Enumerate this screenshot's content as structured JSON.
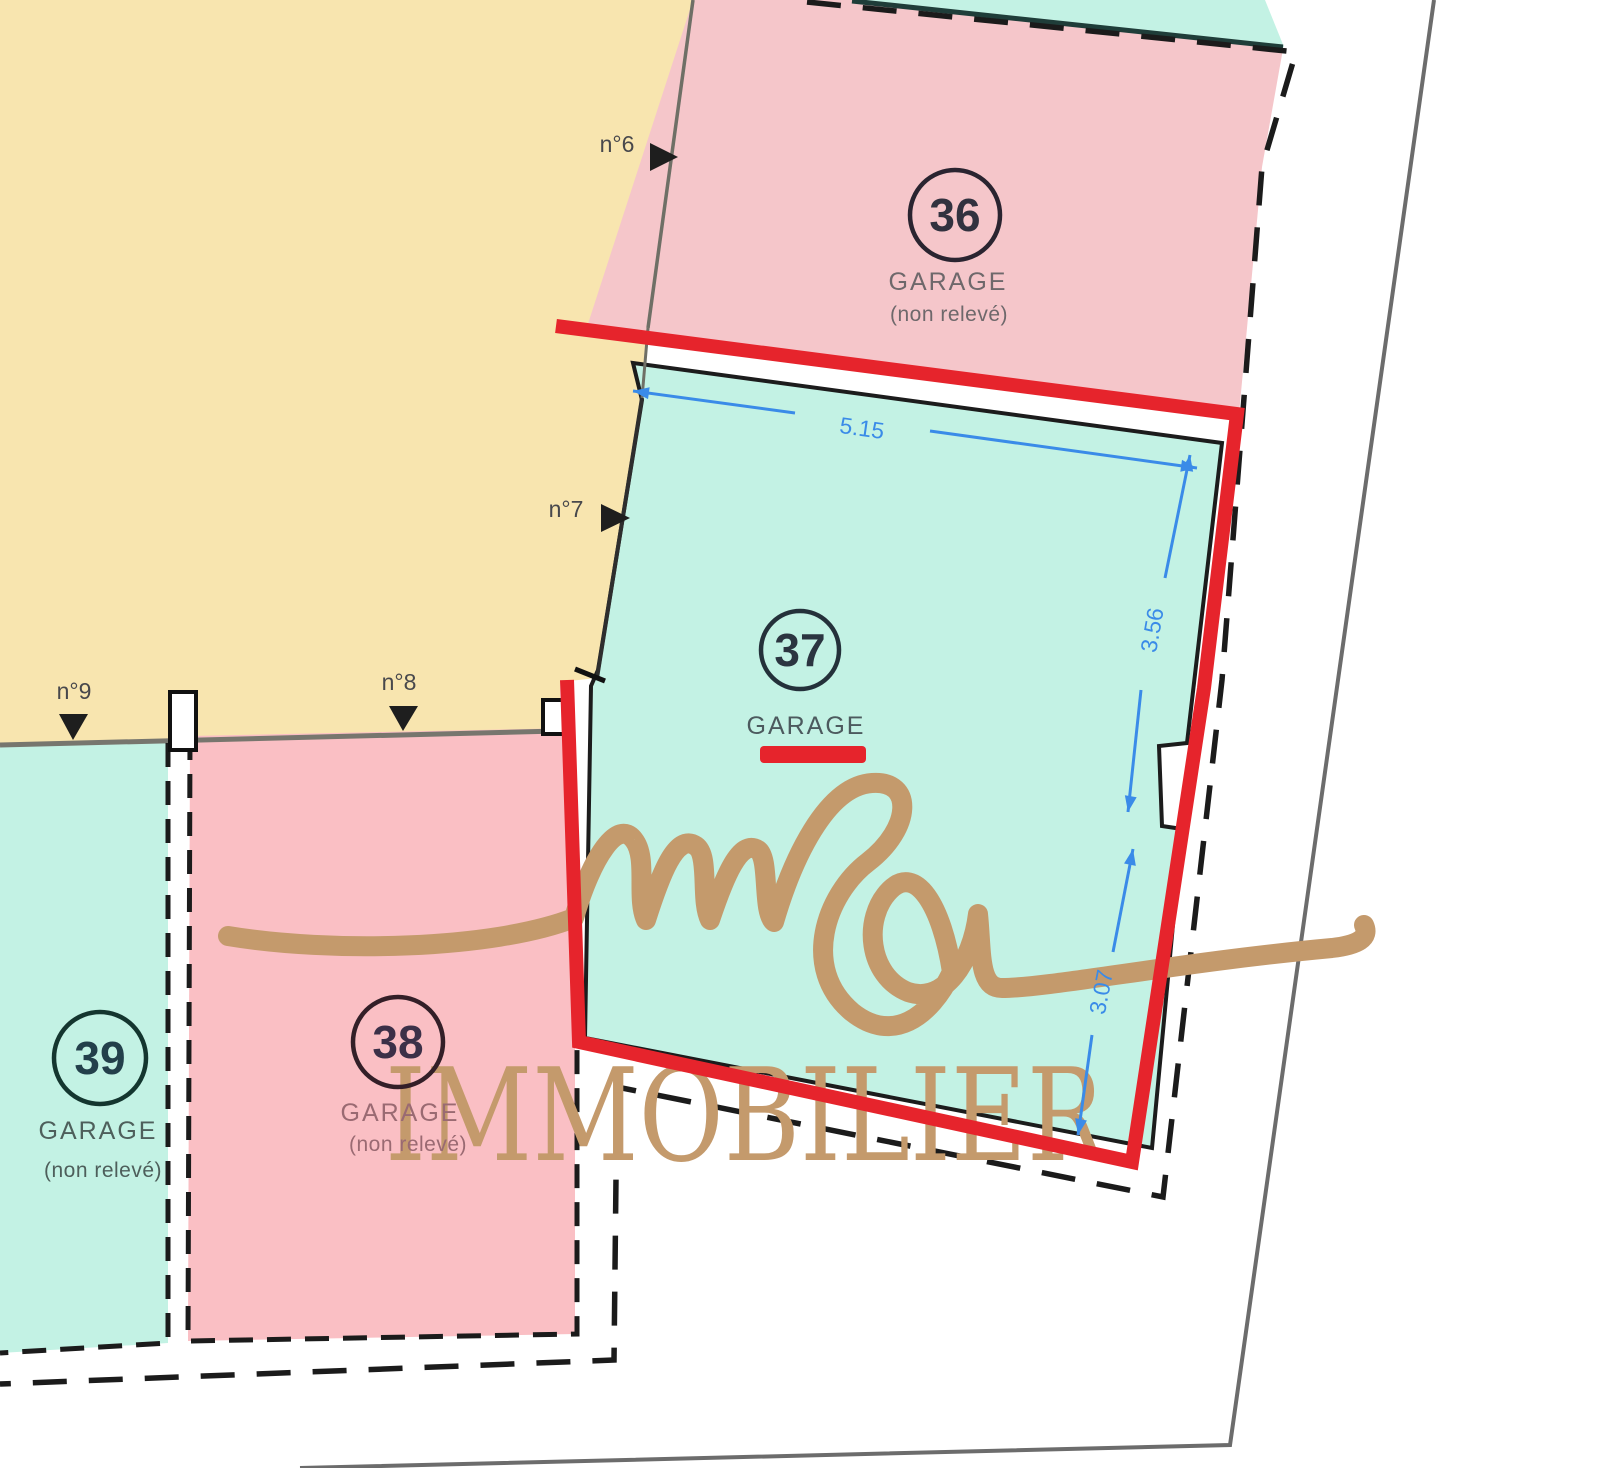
{
  "plan": {
    "watermark": {
      "script": "msa",
      "title": "IMMOBILIER"
    },
    "garages": {
      "g36": {
        "number": "36",
        "label": "GARAGE",
        "note": "(non relevé)"
      },
      "g37": {
        "number": "37",
        "label": "GARAGE"
      },
      "g38": {
        "number": "38",
        "label": "GARAGE",
        "note": "(non relevé)"
      },
      "g39": {
        "number": "39",
        "label": "GARAGE",
        "note": "(non relevé)"
      }
    },
    "entries": {
      "n6": "n°6",
      "n7": "n°7",
      "n8": "n°8",
      "n9": "n°9"
    },
    "dimensions": {
      "top_width": "5.15",
      "right_upper": "3.56",
      "right_lower": "3.07"
    },
    "colors": {
      "highlight_red": "#E6242C",
      "dimension_blue": "#3A8BE8",
      "watermark_gold": "#C49A6C",
      "courtyard_yellow": "#F8E5AF",
      "garage_pink": "#F5C6CA",
      "garage_pink_dark": "#FABFC4",
      "garage_teal": "#C3F2E4"
    }
  }
}
